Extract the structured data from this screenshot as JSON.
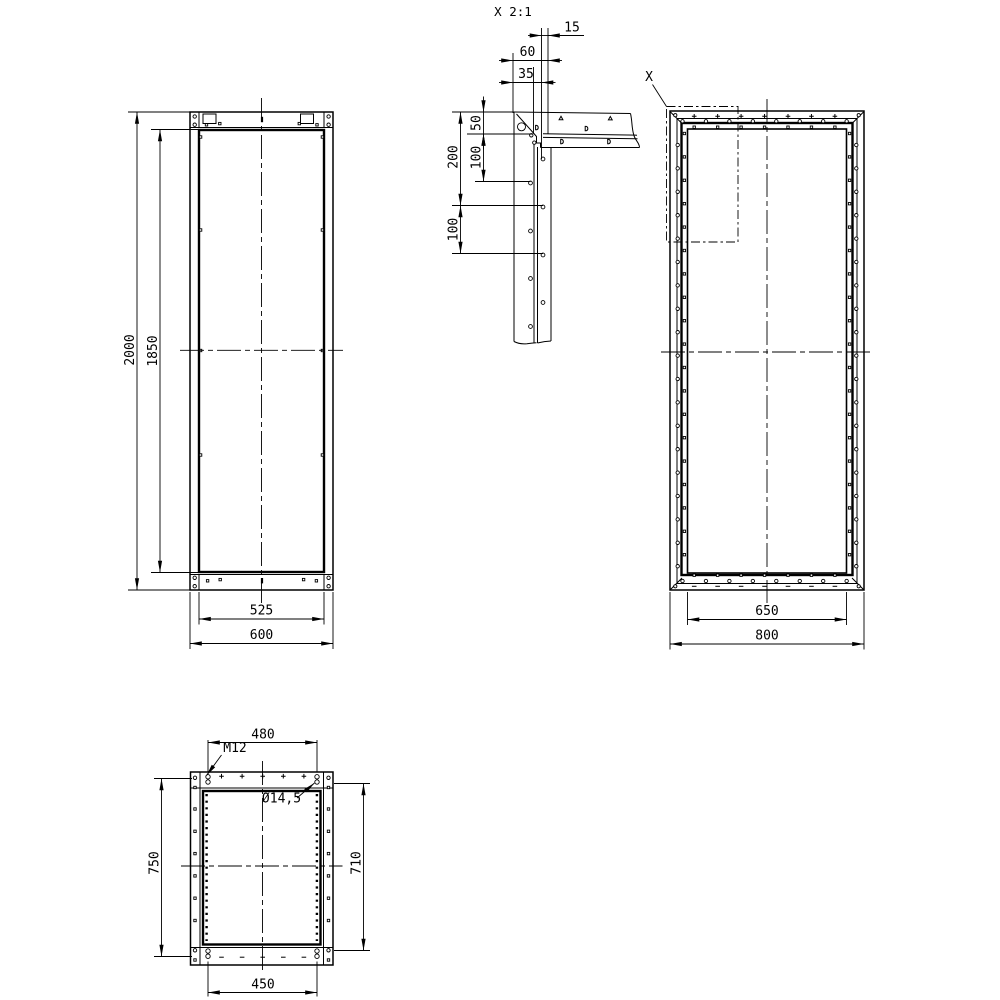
{
  "drawing": {
    "background": "#ffffff",
    "line_color": "#000000",
    "detail_view": {
      "title": "X 2:1",
      "dims": {
        "d15": "15",
        "d60": "60",
        "d35": "35",
        "d50": "50",
        "d200": "200",
        "d100_upper": "100",
        "d100_lower": "100"
      }
    },
    "front_view": {
      "dims": {
        "height_outer": "2000",
        "height_inner": "1850",
        "width_inner": "525",
        "width_outer": "600"
      }
    },
    "rear_view": {
      "detail_marker": "X",
      "dims": {
        "width_inner": "650",
        "width_outer": "800"
      }
    },
    "plan_view": {
      "labels": {
        "thread": "M12",
        "hole_diameter": "Ø14,5"
      },
      "dims": {
        "top_hole_spacing": "480",
        "height_outer": "750",
        "height_inner": "710",
        "bottom_hole_spacing": "450"
      }
    }
  }
}
